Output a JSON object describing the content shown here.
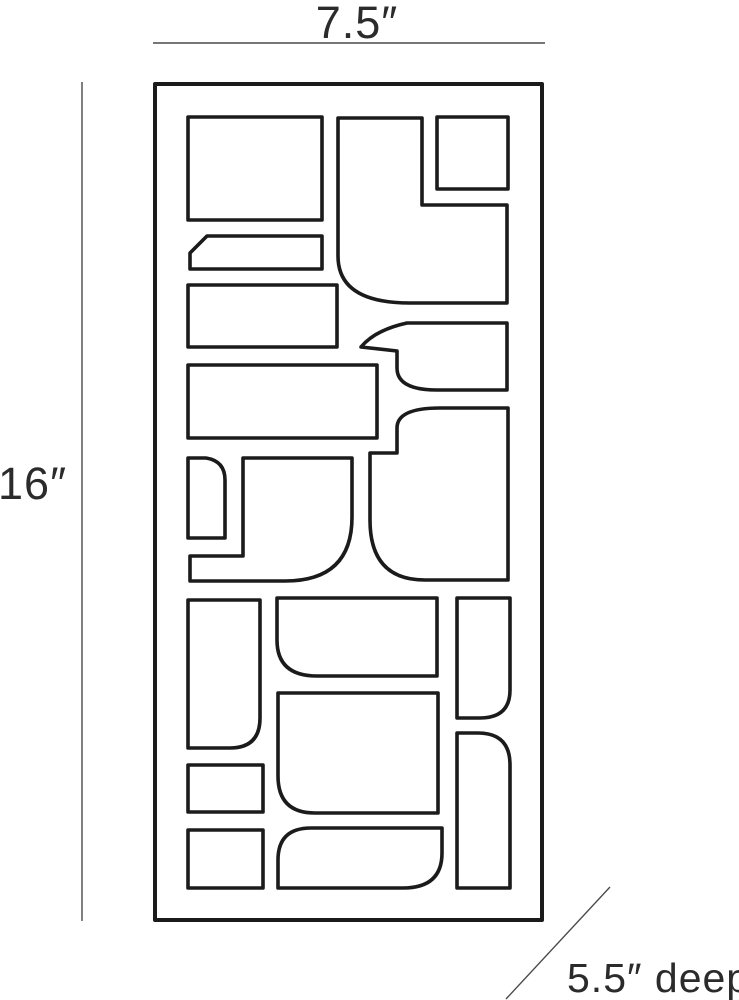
{
  "drawing": {
    "background": "#ffffff",
    "line_color": "#1b1b1b",
    "dimension_line_color": "#4a4a4a",
    "text_color": "#2b2b2b",
    "labels": {
      "width": "7.5″",
      "height": "16″",
      "depth": "5.5″ deep"
    },
    "values": {
      "width_inches": 7.5,
      "height_inches": 16,
      "depth_inches": 5.5
    }
  }
}
